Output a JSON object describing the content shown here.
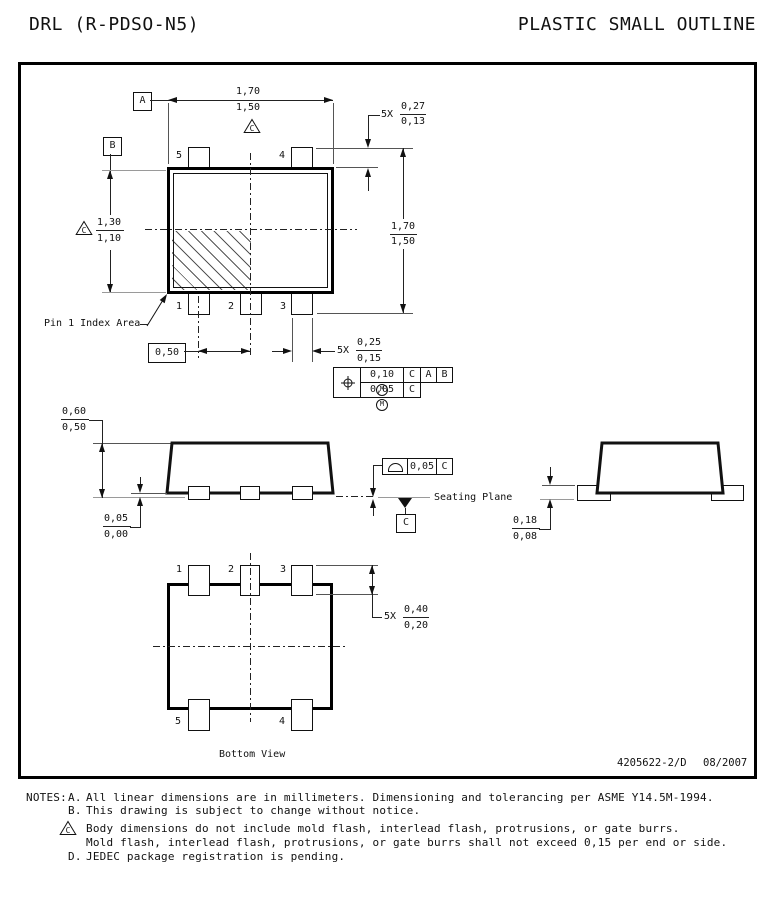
{
  "header": {
    "left_title": "DRL (R-PDSO-N5)",
    "right_title": "PLASTIC SMALL OUTLINE"
  },
  "top_view": {
    "datums": {
      "a": "A",
      "b": "B",
      "flag": "C"
    },
    "dim_width_max": "1,70",
    "dim_width_min": "1,50",
    "dim_body_h_max": "1,30",
    "dim_body_h_min": "1,10",
    "dim_overall_max": "1,70",
    "dim_overall_min": "1,50",
    "lead_len_qty": "5X",
    "lead_len_max": "0,27",
    "lead_len_min": "0,13",
    "pitch": "0,50",
    "lead_w_qty": "5X",
    "lead_w_max": "0,25",
    "lead_w_min": "0,15",
    "pins": {
      "p1": "1",
      "p2": "2",
      "p3": "3",
      "p4": "4",
      "p5": "5"
    },
    "index_label": "Pin 1 Index Area",
    "fcf": {
      "row1_val": "0,10",
      "row1_mod": "M",
      "row1_d1": "C",
      "row1_d2": "A",
      "row1_d3": "B",
      "row2_val": "0,05",
      "row2_mod": "M",
      "row2_d1": "C"
    }
  },
  "side_view": {
    "height_max": "0,60",
    "height_min": "0,50",
    "standoff_max": "0,05",
    "standoff_min": "0,00",
    "flatness_val": "0,05",
    "flatness_datum": "C",
    "seating_label": "Seating Plane",
    "datum_c": "C"
  },
  "end_view": {
    "lead_thk_max": "0,18",
    "lead_thk_min": "0,08"
  },
  "bottom_view": {
    "pins": {
      "p1": "1",
      "p2": "2",
      "p3": "3",
      "p4": "4",
      "p5": "5"
    },
    "pad_qty": "5X",
    "pad_max": "0,40",
    "pad_min": "0,20",
    "caption": "Bottom View"
  },
  "footer": {
    "doc_number": "4205622-2/D",
    "date": "08/2007"
  },
  "notes": {
    "label": "NOTES:",
    "items": [
      {
        "id": "A.",
        "text": "All linear dimensions are in millimeters.  Dimensioning and tolerancing per ASME Y14.5M-1994."
      },
      {
        "id": "B.",
        "text": "This drawing is subject to change without notice."
      },
      {
        "id": "C",
        "text": "Body dimensions do not include mold flash, interlead flash, protrusions, or gate burrs.",
        "text2": "Mold flash, interlead flash, protrusions, or gate burrs shall not exceed 0,15 per end or side."
      },
      {
        "id": "D.",
        "text": "JEDEC package registration is pending."
      }
    ]
  }
}
